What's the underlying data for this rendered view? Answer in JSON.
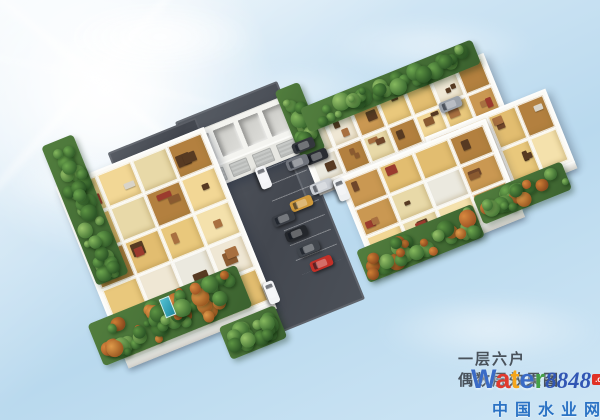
{
  "caption": {
    "line1": "一层六户",
    "line2": "偶数层效果图",
    "color": "#49525b"
  },
  "watermark": {
    "brand_letters": [
      {
        "ch": "W",
        "color": "#3a6bc6"
      },
      {
        "ch": "a",
        "color": "#e03a2e"
      },
      {
        "ch": "t",
        "color": "#f5a61c"
      },
      {
        "ch": "e",
        "color": "#3a6bc6"
      },
      {
        "ch": "r",
        "color": "#43a047"
      }
    ],
    "brand_number": "8848",
    "brand_number_color": "#3156b4",
    "domain_suffix": ".com",
    "domain_suffix_bg": "#e03226",
    "site_name": "中国水业网",
    "site_name_color": "#2a72c4"
  },
  "scene": {
    "sky_color": "#c2ddf0",
    "asphalt_color": "#4b5058",
    "sun": {
      "x": 95,
      "y": 78
    },
    "clouds": [
      {
        "cx": 160,
        "cy": 40,
        "w": 190,
        "h": 64,
        "o": 0.95
      },
      {
        "cx": 430,
        "cy": 48,
        "w": 210,
        "h": 52,
        "o": 0.5
      },
      {
        "cx": 300,
        "cy": 92,
        "w": 150,
        "h": 42,
        "o": 0.4
      },
      {
        "cx": 75,
        "cy": 185,
        "w": 130,
        "h": 46,
        "o": 0.45
      },
      {
        "cx": 490,
        "cy": 332,
        "w": 220,
        "h": 64,
        "o": 0.55
      }
    ],
    "parking_lots": [
      {
        "cx": 270,
        "cy": 210,
        "w": 110,
        "h": 235
      },
      {
        "cx": 390,
        "cy": 140,
        "w": 200,
        "h": 45
      },
      {
        "cx": 162,
        "cy": 162,
        "w": 95,
        "h": 58
      }
    ],
    "stall_lines": {
      "cx": 300,
      "cy": 212,
      "w": 44,
      "h": 118
    },
    "garage": {
      "cx": 243,
      "cy": 143,
      "w": 112,
      "h": 58,
      "bays": 4,
      "doors": 4
    },
    "wings": [
      {
        "name": "left",
        "cx": 160,
        "cy": 240,
        "w": 150,
        "h": 180,
        "cols": 4,
        "rows": 5
      },
      {
        "name": "upper-right",
        "cx": 395,
        "cy": 116,
        "w": 195,
        "h": 55,
        "cols": 7,
        "rows": 2
      },
      {
        "name": "right-upper",
        "cx": 495,
        "cy": 145,
        "w": 120,
        "h": 70,
        "cols": 4,
        "rows": 2
      },
      {
        "name": "right-mid",
        "cx": 425,
        "cy": 190,
        "w": 150,
        "h": 90,
        "cols": 4,
        "rows": 3
      }
    ],
    "room_palette": [
      "#f2d795",
      "#e9c87c",
      "#f4e1ac",
      "#e2bd70",
      "#efe7d4",
      "#ca9852",
      "#b3803f",
      "#e8d9a8"
    ],
    "room_void_color": "#ebe9df",
    "furniture_palette": [
      "#8a5a30",
      "#6f462a",
      "#a87040",
      "#d9d4c8",
      "#573a22",
      "#9b3b2e"
    ],
    "gardens": [
      {
        "name": "left-edge",
        "cx": 85,
        "cy": 210,
        "w": 34,
        "h": 150,
        "autumn": false
      },
      {
        "name": "bottom-left",
        "cx": 170,
        "cy": 315,
        "w": 160,
        "h": 45,
        "autumn": true
      },
      {
        "name": "garage-right",
        "cx": 300,
        "cy": 120,
        "w": 26,
        "h": 72,
        "autumn": false
      },
      {
        "name": "upper-wing-top",
        "cx": 390,
        "cy": 86,
        "w": 185,
        "h": 26,
        "autumn": false
      },
      {
        "name": "right-upper-edge",
        "cx": 522,
        "cy": 193,
        "w": 95,
        "h": 30,
        "autumn": true
      },
      {
        "name": "right-mid-edge",
        "cx": 420,
        "cy": 243,
        "w": 125,
        "h": 35,
        "autumn": true
      },
      {
        "name": "bottom-tip",
        "cx": 253,
        "cy": 332,
        "w": 60,
        "h": 35,
        "autumn": false
      }
    ],
    "tree_greens": [
      [
        "#86b95e",
        "#3f6f33"
      ],
      [
        "#6ea84f",
        "#35612c"
      ],
      [
        "#9ac56b",
        "#4a7a38"
      ],
      [
        "#5d9443",
        "#2c5526"
      ]
    ],
    "tree_autumn": [
      [
        "#e09a4a",
        "#9c5a22"
      ],
      [
        "#cf7f35",
        "#8a4a1e"
      ],
      [
        "#d8893f",
        "#a05524"
      ]
    ],
    "pool": {
      "cx": 166,
      "cy": 306,
      "w": 9,
      "h": 18
    },
    "cars": [
      {
        "cx": 263,
        "cy": 177,
        "angle": 68,
        "color": "#f3f4f6"
      },
      {
        "cx": 271,
        "cy": 292,
        "angle": 68,
        "color": "#f3f4f6"
      },
      {
        "cx": 316,
        "cy": 156,
        "angle": -22,
        "color": "#2a2d33"
      },
      {
        "cx": 321,
        "cy": 186,
        "angle": -22,
        "color": "#c9cdd3"
      },
      {
        "cx": 301,
        "cy": 203,
        "angle": -22,
        "color": "#d09a3c"
      },
      {
        "cx": 283,
        "cy": 218,
        "angle": -22,
        "color": "#3a3e45"
      },
      {
        "cx": 296,
        "cy": 233,
        "angle": -22,
        "color": "#24272c"
      },
      {
        "cx": 308,
        "cy": 248,
        "angle": -22,
        "color": "#40454c"
      },
      {
        "cx": 321,
        "cy": 263,
        "angle": -22,
        "color": "#c23028"
      },
      {
        "cx": 303,
        "cy": 145,
        "angle": -22,
        "color": "#34373d"
      },
      {
        "cx": 297,
        "cy": 162,
        "angle": -22,
        "color": "#70747c"
      },
      {
        "cx": 450,
        "cy": 104,
        "angle": -22,
        "color": "#9ba1a9"
      },
      {
        "cx": 341,
        "cy": 189,
        "angle": 68,
        "color": "#eef0f2"
      }
    ]
  }
}
